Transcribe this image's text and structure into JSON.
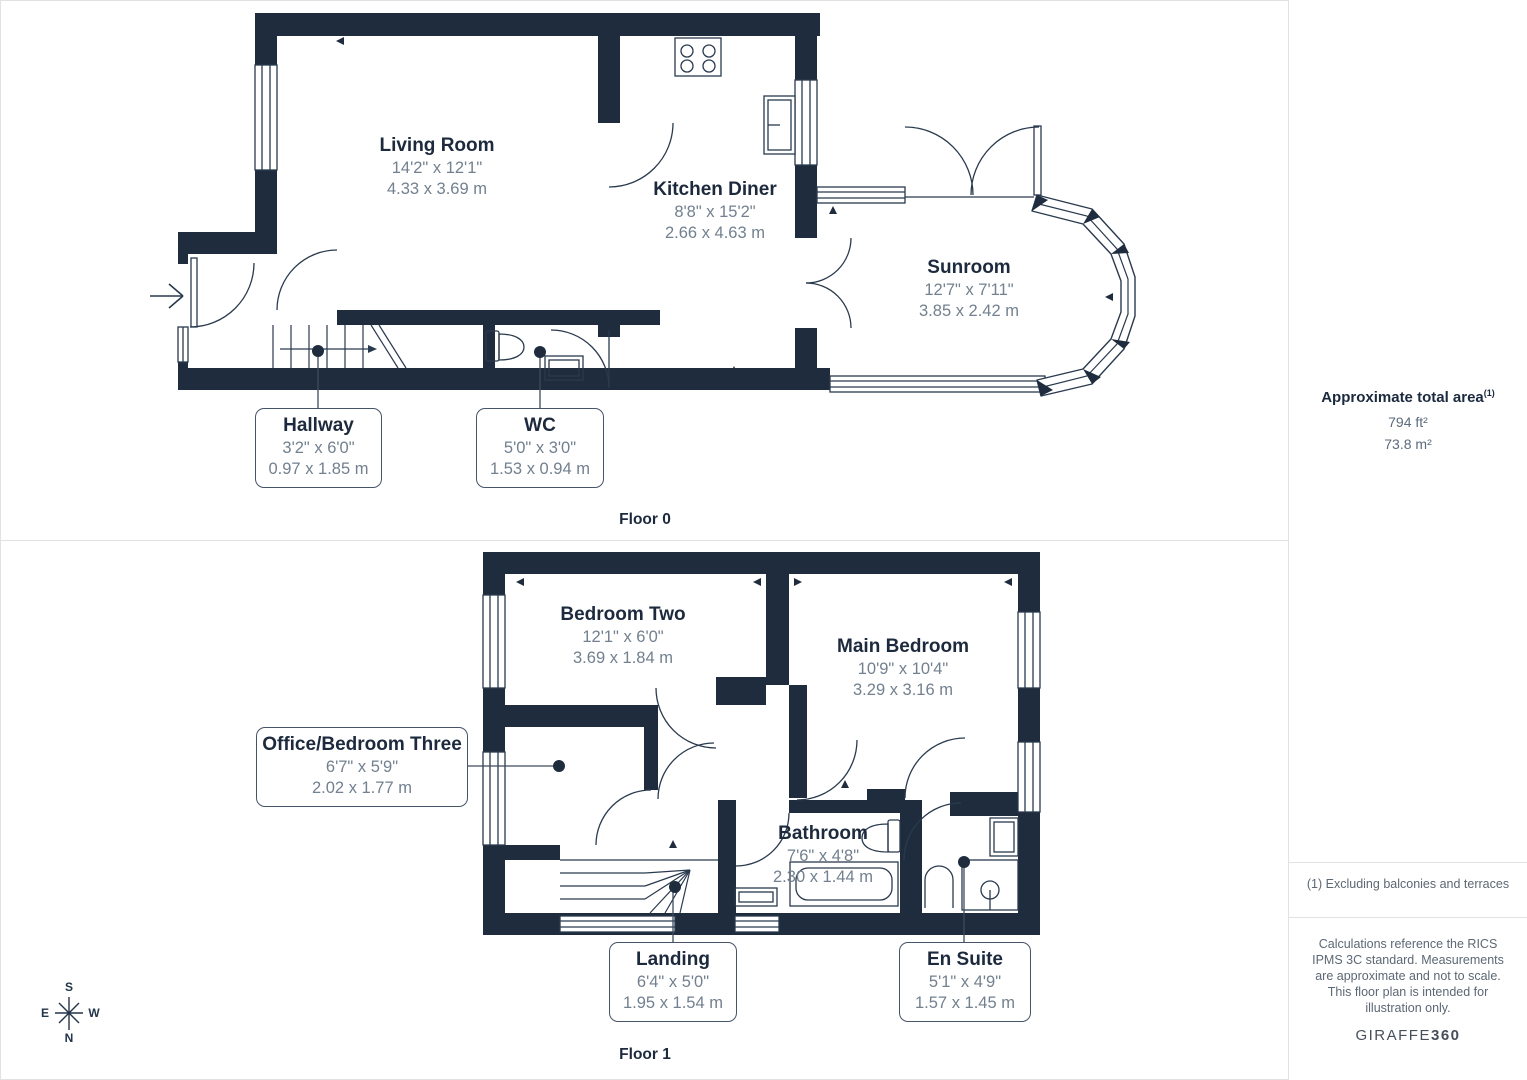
{
  "floors": [
    {
      "label": "Floor 0"
    },
    {
      "label": "Floor 1"
    }
  ],
  "rooms": {
    "living_room": {
      "name": "Living Room",
      "imperial": "14'2\" x 12'1\"",
      "metric": "4.33 x 3.69 m"
    },
    "kitchen_diner": {
      "name": "Kitchen Diner",
      "imperial": "8'8\" x 15'2\"",
      "metric": "2.66 x 4.63 m"
    },
    "sunroom": {
      "name": "Sunroom",
      "imperial": "12'7\" x 7'11\"",
      "metric": "3.85 x 2.42 m"
    },
    "hallway": {
      "name": "Hallway",
      "imperial": "3'2\" x 6'0\"",
      "metric": "0.97 x 1.85 m"
    },
    "wc": {
      "name": "WC",
      "imperial": "5'0\" x 3'0\"",
      "metric": "1.53 x 0.94 m"
    },
    "bedroom_two": {
      "name": "Bedroom Two",
      "imperial": "12'1\" x 6'0\"",
      "metric": "3.69 x 1.84 m"
    },
    "main_bedroom": {
      "name": "Main Bedroom",
      "imperial": "10'9\" x 10'4\"",
      "metric": "3.29 x 3.16 m"
    },
    "office": {
      "name": "Office/Bedroom Three",
      "imperial": "6'7\" x 5'9\"",
      "metric": "2.02 x 1.77 m"
    },
    "bathroom": {
      "name": "Bathroom",
      "imperial": "7'6\" x 4'8\"",
      "metric": "2.30 x 1.44 m"
    },
    "landing": {
      "name": "Landing",
      "imperial": "6'4\" x 5'0\"",
      "metric": "1.95 x 1.54 m"
    },
    "en_suite": {
      "name": "En Suite",
      "imperial": "5'1\" x 4'9\"",
      "metric": "1.57 x 1.45 m"
    }
  },
  "sidebar": {
    "area_title": "Approximate total area",
    "area_ref": "(1)",
    "area_ft": "794 ft²",
    "area_m": "73.8 m²",
    "footnote": "(1) Excluding balconies and terraces",
    "disclaimer": "Calculations reference the RICS IPMS 3C standard. Measurements are approximate and not to scale. This floor plan is intended for illustration only.",
    "brand": "GIRAFFE",
    "brand_bold": "360"
  },
  "compass": {
    "n": "N",
    "s": "S",
    "e": "E",
    "w": "W"
  },
  "colors": {
    "wall": "#1f2c3d",
    "title_text": "#1d2a3d",
    "dim_text": "#72808f",
    "line": "#2a3a4e"
  }
}
